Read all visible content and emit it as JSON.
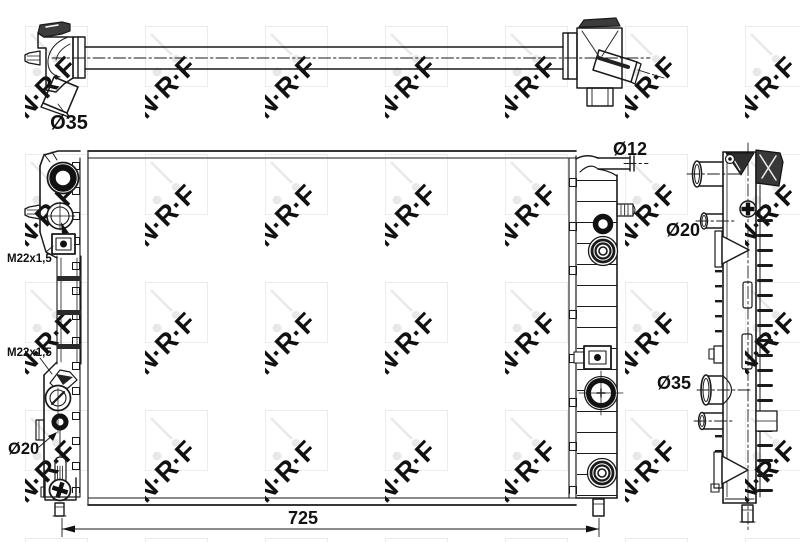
{
  "watermark": {
    "logo_text": "N·R·F"
  },
  "labels": {
    "top_hose_diameter": "Ø35",
    "bleed_pipe_diameter": "Ø12",
    "side_upper_port_diameter": "Ø20",
    "thread_spec_upper": "M22x1,5",
    "thread_spec_lower": "M22x1,5",
    "side_lower_port_diameter": "Ø35",
    "left_lower_port_diameter": "Ø20"
  },
  "dimension": {
    "core_width": "725"
  },
  "colors": {
    "line": "#1a1a1a",
    "watermark": "#e8e8e8",
    "background": "#ffffff"
  }
}
